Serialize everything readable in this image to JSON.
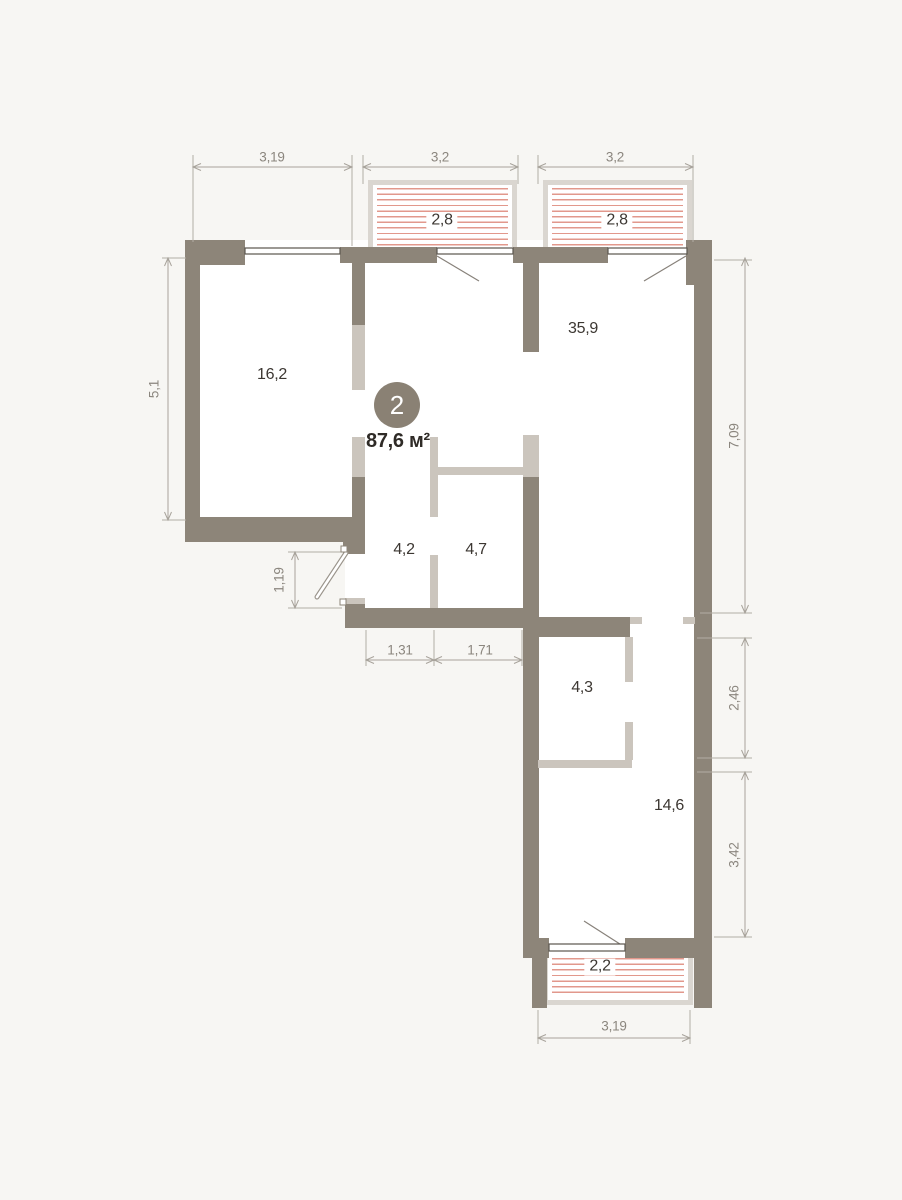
{
  "plan": {
    "badge": {
      "number": "2",
      "total_area": "87,6 м²"
    },
    "rooms": {
      "bedroom": {
        "label": "16,2"
      },
      "living": {
        "label": "35,9"
      },
      "hall": {
        "label": "4,2"
      },
      "wardrobe": {
        "label": "4,7"
      },
      "bathroom": {
        "label": "4,3"
      },
      "bedroom2": {
        "label": "14,6"
      }
    },
    "balconies": {
      "top_left": {
        "label": "2,8"
      },
      "top_right": {
        "label": "2,8"
      },
      "bottom": {
        "label": "2,2"
      }
    },
    "dimensions": {
      "top": [
        "3,19",
        "3,2",
        "3,2"
      ],
      "left_height": "5,1",
      "entry_width": "1,19",
      "hall_widths": [
        "1,31",
        "1,71"
      ],
      "right_heights": [
        "7,09",
        "2,46",
        "3,42"
      ],
      "bottom_width": "3,19"
    },
    "colors": {
      "background": "#f7f6f3",
      "room_fill": "#ffffff",
      "wall_dark": "#8d8579",
      "wall_light": "#cbc5bd",
      "balcony_frame": "#dad6d0",
      "hatch_red": "#e2988c",
      "dimension_lines": "#b2ada5",
      "dimension_text": "#8b867e",
      "room_text": "#3c3732",
      "badge_fill": "#8a8174",
      "badge_text": "#ffffff"
    }
  }
}
